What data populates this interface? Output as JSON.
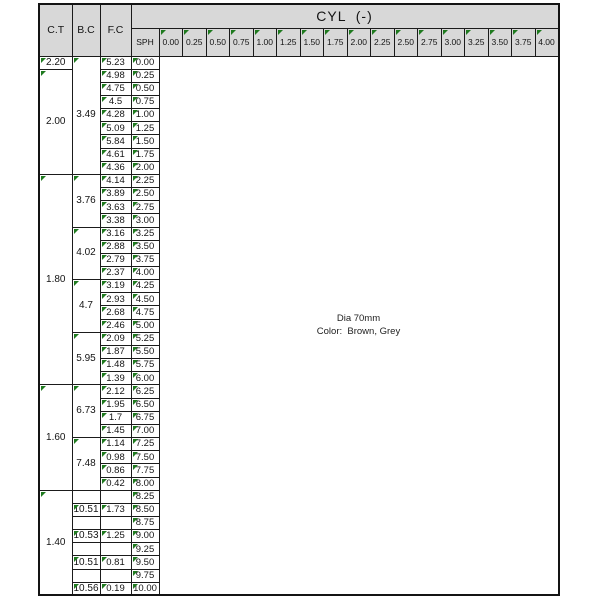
{
  "colors": {
    "header_bg": "#d8d8d8",
    "border": "#1b1b1b",
    "marker_green": "#1f7a1f",
    "page_bg": "#ffffff"
  },
  "header": {
    "corner": [
      "C.T",
      "B.C",
      "F.C"
    ],
    "cyl_title": "CYL  (-)",
    "sph_label": "SPH",
    "cyl_values": [
      "0.00",
      "0.25",
      "0.50",
      "0.75",
      "1.00",
      "1.25",
      "1.50",
      "1.75",
      "2.00",
      "2.25",
      "2.50",
      "2.75",
      "3.00",
      "3.25",
      "3.50",
      "3.75",
      "4.00"
    ]
  },
  "body": {
    "sph": [
      "0.00",
      "0.25",
      "0.50",
      "0.75",
      "1.00",
      "1.25",
      "1.50",
      "1.75",
      "2.00",
      "2.25",
      "2.50",
      "2.75",
      "3.00",
      "3.25",
      "3.50",
      "3.75",
      "4.00",
      "4.25",
      "4.50",
      "4.75",
      "5.00",
      "5.25",
      "5.50",
      "5.75",
      "6.00",
      "6.25",
      "6.50",
      "6.75",
      "7.00",
      "7.25",
      "7.50",
      "7.75",
      "8.00",
      "8.25",
      "8.50",
      "8.75",
      "9.00",
      "9.25",
      "9.50",
      "9.75",
      "10.00"
    ],
    "fc": [
      "5.23",
      "4.98",
      "4.75",
      "4.5",
      "4.28",
      "5.09",
      "5.84",
      "4.61",
      "4.36",
      "4.14",
      "3.89",
      "3.63",
      "3.38",
      "3.16",
      "2.88",
      "2.79",
      "2.37",
      "3.19",
      "2.93",
      "2.68",
      "2.46",
      "2.09",
      "1.87",
      "1.48",
      "1.39",
      "2.12",
      "1.95",
      "1.7",
      "1.45",
      "1.14",
      "0.98",
      "0.86",
      "0.42",
      "",
      "1.73",
      "",
      "1.25",
      "",
      "0.81",
      "",
      "0.19"
    ],
    "bc_groups": [
      {
        "value": "3.49",
        "start": 0,
        "span": 9
      },
      {
        "value": "3.76",
        "start": 9,
        "span": 4
      },
      {
        "value": "4.02",
        "start": 13,
        "span": 4
      },
      {
        "value": "4.7",
        "start": 17,
        "span": 4
      },
      {
        "value": "5.95",
        "start": 21,
        "span": 4
      },
      {
        "value": "6.73",
        "start": 25,
        "span": 4
      },
      {
        "value": "7.48",
        "start": 29,
        "span": 4
      },
      {
        "value": "",
        "start": 33,
        "span": 1
      },
      {
        "value": "10.51",
        "start": 34,
        "span": 1
      },
      {
        "value": "",
        "start": 35,
        "span": 1
      },
      {
        "value": "10.53",
        "start": 36,
        "span": 1
      },
      {
        "value": "",
        "start": 37,
        "span": 1
      },
      {
        "value": "10.51",
        "start": 38,
        "span": 1
      },
      {
        "value": "",
        "start": 39,
        "span": 1
      },
      {
        "value": "10.56",
        "start": 40,
        "span": 1
      }
    ],
    "ct_groups": [
      {
        "value": "2.20",
        "start": 0,
        "span": 1
      },
      {
        "value": "2.00",
        "start": 1,
        "span": 8
      },
      {
        "value": "1.80",
        "start": 9,
        "span": 16
      },
      {
        "value": "1.60",
        "start": 25,
        "span": 8
      },
      {
        "value": "1.40",
        "start": 33,
        "span": 8
      }
    ],
    "notes": {
      "line1": "Dia 70mm",
      "line2": "Color:  Brown, Grey"
    }
  }
}
